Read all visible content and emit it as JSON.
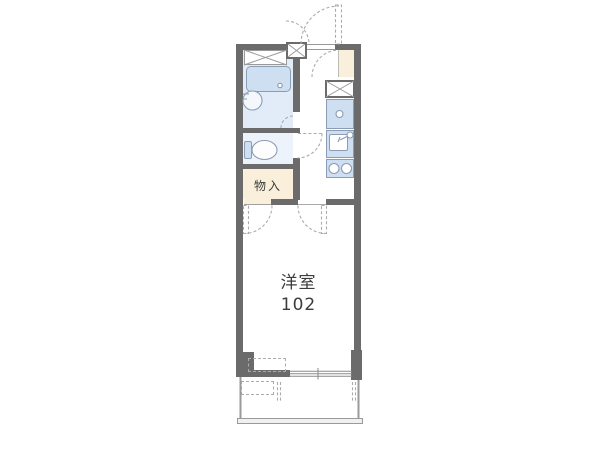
{
  "colors": {
    "wall": "#6b6b6b",
    "fixture": "#cfdff2",
    "fixture_border": "#8b9cb4",
    "bath_floor": "#e2ecf9",
    "toilet_floor": "#edf3fb",
    "cream": "#f9efda",
    "dash": "#ababab",
    "thin_line": "#999999",
    "label_text": "#3c3c3c",
    "balcony_line": "#9a9a9a"
  },
  "labels": {
    "storage": "物入",
    "main_room": "洋室",
    "main_room_number": "102"
  },
  "fixtures": [
    "bathroom-shelf",
    "bathtub",
    "wash-basin",
    "toilet",
    "shoe-cabinet",
    "washing-machine-space",
    "kitchen-counter",
    "kitchen-sink",
    "kitchen-faucet",
    "gas-stove",
    "entrance-door",
    "room-door",
    "closet-door",
    "toilet-door",
    "sliding-window",
    "air-conditioner-outline",
    "balcony"
  ]
}
